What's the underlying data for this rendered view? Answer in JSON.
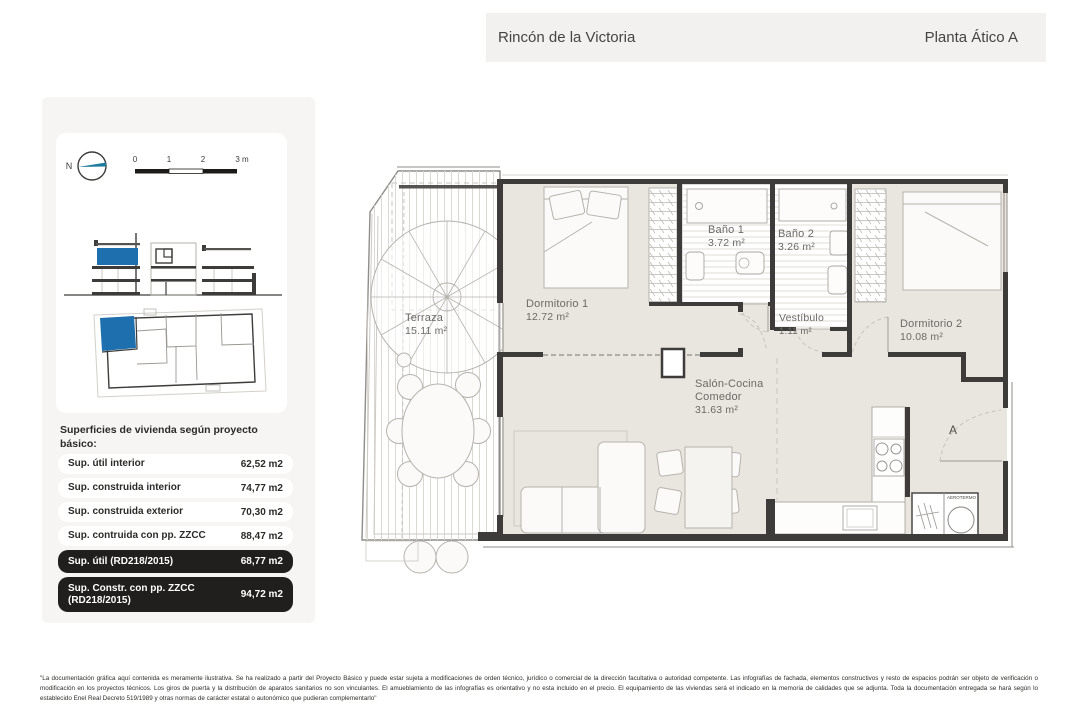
{
  "header": {
    "location": "Rincón de la Victoria",
    "plan_title": "Planta Ático A"
  },
  "map_tools": {
    "north_label": "N",
    "scale_ticks": {
      "t0": "0",
      "t1": "1",
      "t2": "2",
      "t3": "3 m"
    }
  },
  "surfaces": {
    "heading": "Superficies de vivienda según proyecto básico:",
    "rows": [
      {
        "label": "Sup. útil interior",
        "value": "62,52 m2",
        "highlight": false
      },
      {
        "label": "Sup. construida interior",
        "value": "74,77 m2",
        "highlight": false
      },
      {
        "label": "Sup. construida exterior",
        "value": "70,30 m2",
        "highlight": false
      },
      {
        "label": "Sup. contruida con pp. ZZCC",
        "value": "88,47 m2",
        "highlight": false
      },
      {
        "label": "Sup. útil (RD218/2015)",
        "value": "68,77 m2",
        "highlight": true
      },
      {
        "label": "Sup. Constr. con pp. ZZCC (RD218/2015)",
        "value": "94,72 m2",
        "highlight": true
      }
    ]
  },
  "rooms": {
    "terraza": {
      "name": "Terraza",
      "area": "15.11 m²"
    },
    "dormitorio1": {
      "name": "Dormitorio 1",
      "area": "12.72 m²"
    },
    "bano1": {
      "name": "Baño 1",
      "area": "3.72 m²"
    },
    "bano2": {
      "name": "Baño 2",
      "area": "3.26 m²"
    },
    "vestibulo": {
      "name": "Vestíbulo",
      "area": "1.11 m²"
    },
    "dormitorio2": {
      "name": "Dormitorio 2",
      "area": "10.08 m²"
    },
    "salon": {
      "line1": "Salón-Cocina",
      "line2": "Comedor",
      "area": "31.63 m²"
    }
  },
  "plan_labels": {
    "entrance_door": "A",
    "water_heater": "AEROTERMO"
  },
  "disclaimer": "\"La documentación gráfica aquí contenida es meramente ilustrativa. Se ha realizado a partir del Proyecto Básico y puede estar sujeta a modificaciones de orden técnico, jurídico o comercial de la dirección facultativa o autoridad competente. Las infografías de fachada, elementos constructivos y resto de espacios podrán ser objeto de verificación o modificación en los proyectos técnicos. Los giros de puerta y la distribución de aparatos sanitarios no son vinculantes. El amueblamiento de las infografías es orientativo y no esta incluido en el precio. El equipamiento de las viviendas será el indicado en la memoria de calidades que se adjunta. Toda la documentación entregada se hará según lo establecido Enel Real Decreto 519/1989 y otras normas de carácter estatal o autonómico que pudieran complementarlo\"",
  "colors": {
    "accent_blue": "#1d6fae",
    "room_fill": "#e9e5df",
    "header_bg": "#f2f1f0",
    "panel_bg": "#f6f5f4",
    "dark_pill_bg": "#201f1d",
    "wall": "#3d3c3a"
  }
}
